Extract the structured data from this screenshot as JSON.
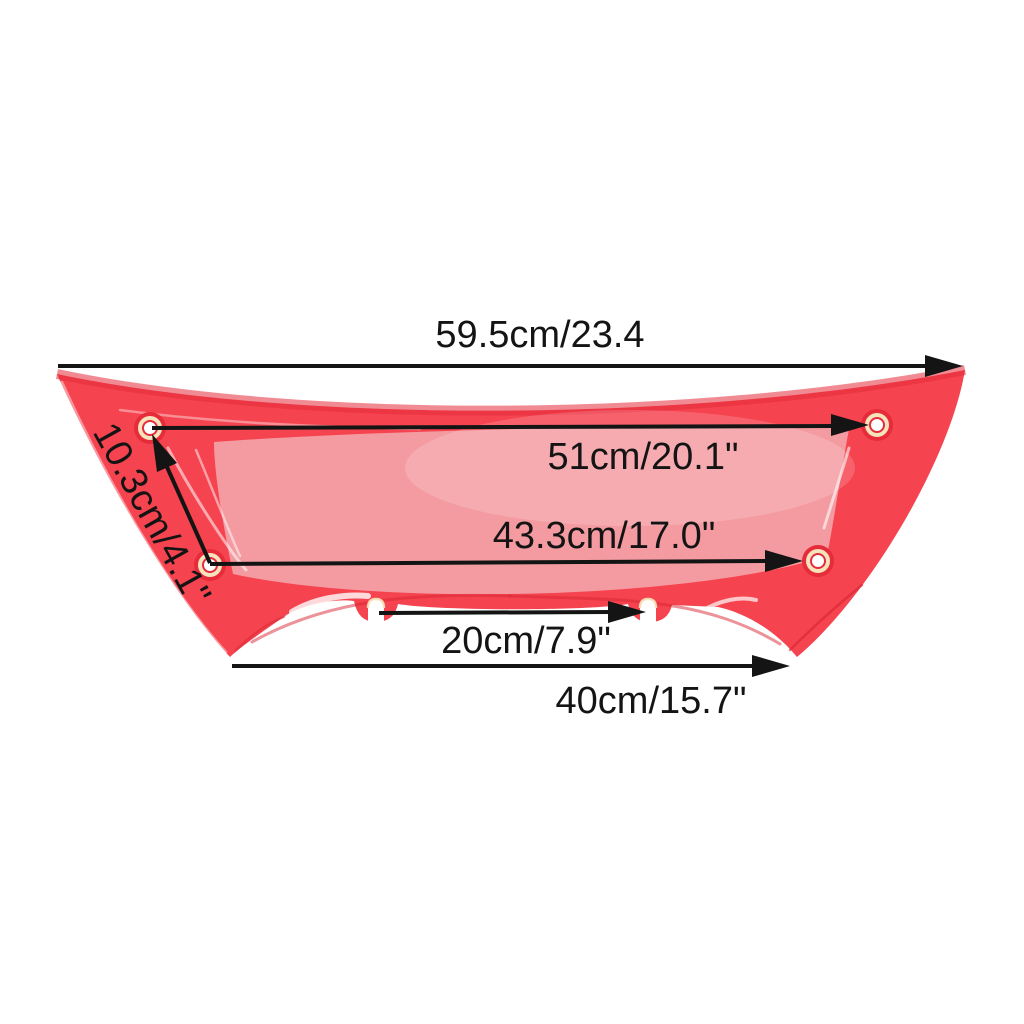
{
  "product": {
    "description": "Red windshield trim fairing part dimension diagram",
    "colors": {
      "background": "#ffffff",
      "part_red": "#f5434f",
      "part_red_dark": "#e62b3a",
      "window_pink": "#f49ba1",
      "dimension_line": "#141414",
      "grommet_ring": "#f6e3bd",
      "hole_white": "#ffffff"
    },
    "dimensions": [
      {
        "id": "overall-top-width",
        "label": "59.5cm/23.4"
      },
      {
        "id": "upper-hole-span",
        "label": "51cm/20.1\""
      },
      {
        "id": "lower-hole-span",
        "label": "43.3cm/17.0\""
      },
      {
        "id": "bottom-tab-span",
        "label": "20cm/7.9\""
      },
      {
        "id": "bottom-width",
        "label": "40cm/15.7\""
      },
      {
        "id": "left-hole-vertical-span",
        "label": "10.3cm/4.1\""
      }
    ]
  }
}
